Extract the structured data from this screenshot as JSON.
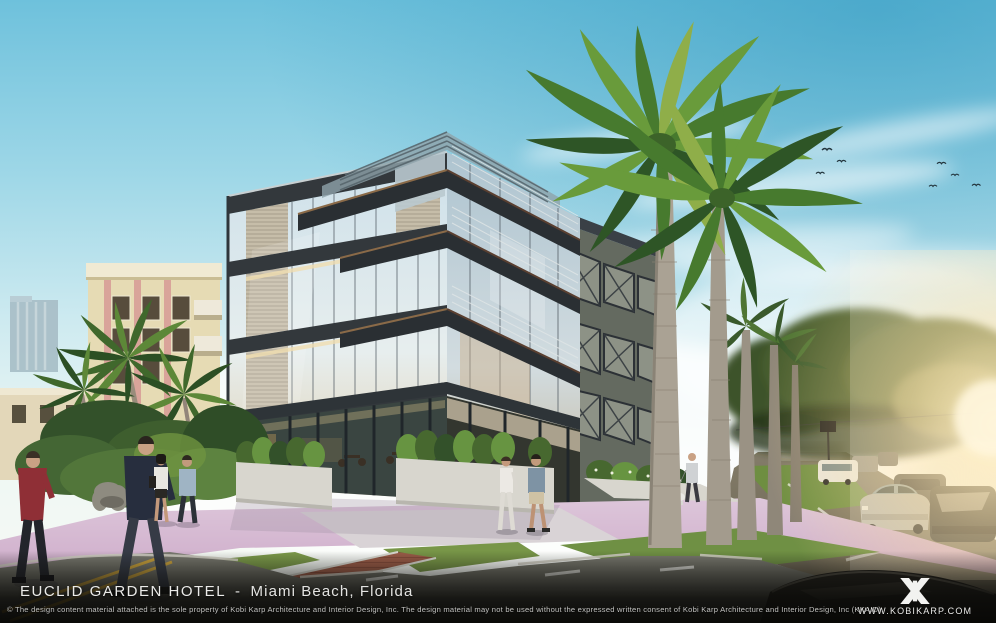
{
  "caption_bar": {
    "project_name": "EUCLID GARDEN HOTEL",
    "separator": "-",
    "location": "Miami Beach, Florida",
    "copyright": "© The design content material attached is the sole property of Kobi Karp Architecture and Interior Design, Inc. The design material may not be used without the expressed written consent of Kobi Karp Architecture and Interior Design, Inc (KKAID).",
    "website": "WWW.KOBIKARP.COM",
    "logo_icon": "kobi-karp-monogram-icon",
    "text_color": "#ebebe9",
    "bar_color": "#0a0a08"
  },
  "scene": {
    "subject": "Architectural rendering of a four-story modern glass hotel on a Miami Beach street corner",
    "elements": [
      "blue sky with wispy clouds and birds",
      "distant high-rise tower",
      "cream art deco apartment building",
      "glass hotel with cantilevered balconies and x-braced bays",
      "royal palm trees",
      "pink sidewalks and white planters",
      "ground-floor cafe terrace",
      "street with parked cars and warm sun glare",
      "pedestrians walking"
    ],
    "colors": {
      "sky_top": "#5fb6d6",
      "sky_horizon": "#eef6f4",
      "sidewalk_pink": "#d5b6d3",
      "palm_green": "#4a7c30",
      "grass_green": "#7c9a4a",
      "asphalt": "#6b6b62",
      "steel_frame": "#353b40",
      "glass_reflection": "#cfe0ea",
      "sun_glow": "#ffe2a8",
      "crosswalk_brick": "#9a5c48"
    }
  }
}
